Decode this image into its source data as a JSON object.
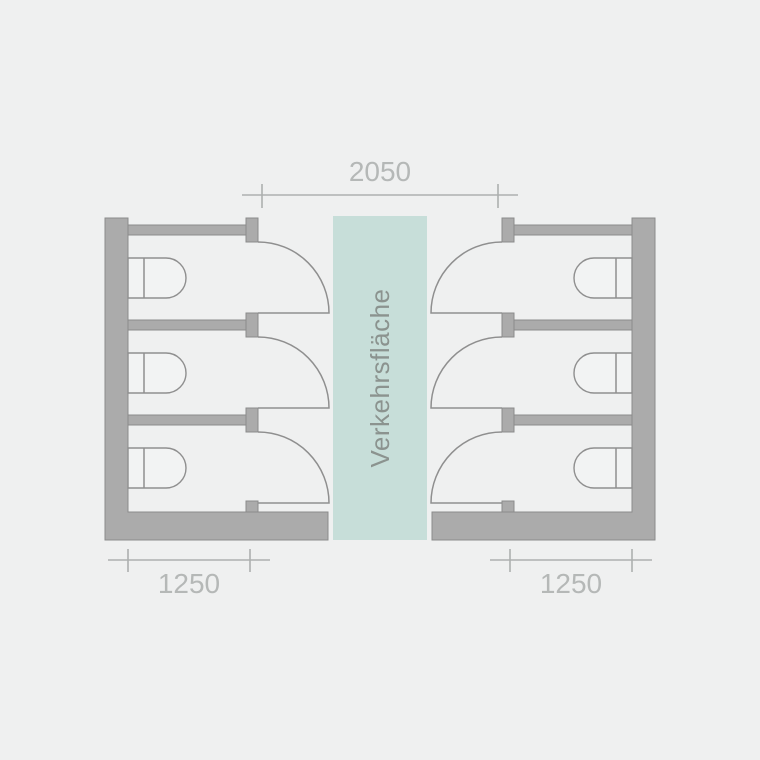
{
  "diagram": {
    "type": "floor-plan",
    "subject": "toilet-stall-layout-with-central-circulation-zone",
    "corridor": {
      "label": "Verkehrsfläche",
      "fill_color": "#c7ded9",
      "label_color": "#8b938f"
    },
    "dimensions": {
      "corridor_width": {
        "value": "2050"
      },
      "stall_depth_left": {
        "value": "1250"
      },
      "stall_depth_right": {
        "value": "1250"
      }
    },
    "stalls": {
      "left_count": 3,
      "right_count": 3
    },
    "colors": {
      "background": "#eff0f0",
      "wall_fill": "#ababab",
      "wall_stroke": "#8b8b8b",
      "line": "#8f8f8f",
      "dimension_line": "#adb0af",
      "dimension_text": "#b5b8b7"
    }
  }
}
